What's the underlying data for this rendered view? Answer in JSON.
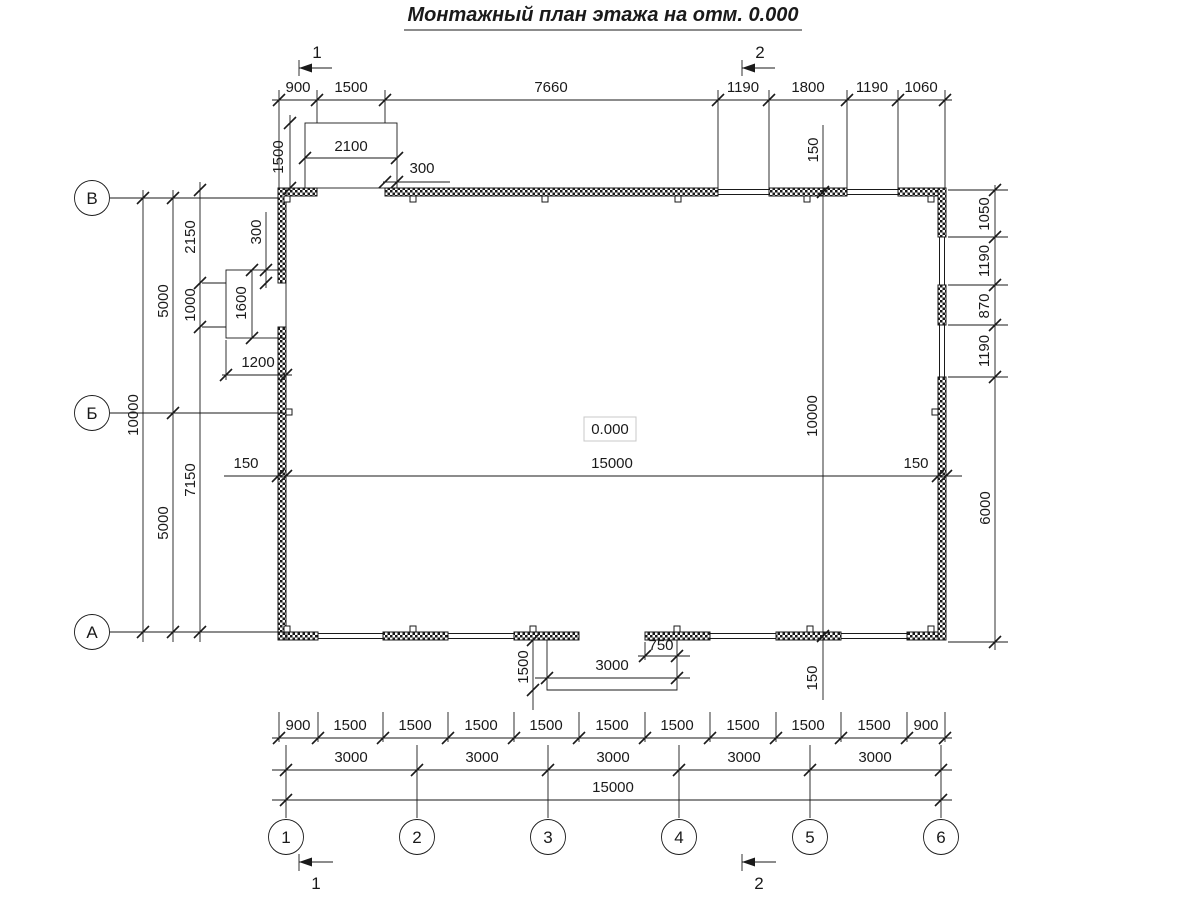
{
  "title": "Монтажный план этажа на отм. 0.000",
  "elevation": "0.000",
  "axes": {
    "rows": [
      "В",
      "Б",
      "А"
    ],
    "cols": [
      "1",
      "2",
      "3",
      "4",
      "5",
      "6"
    ]
  },
  "sections": {
    "one": "1",
    "two": "2"
  },
  "dims": {
    "top_chain": [
      "900",
      "1500",
      "7660",
      "1190",
      "1800",
      "1190",
      "1060"
    ],
    "porch_top": {
      "depth": "1500",
      "width": "2100",
      "offset": "300"
    },
    "left": {
      "total": "10000",
      "upper": "5000",
      "lower": "5000",
      "to_opening": "2150",
      "opening_gap": "1000",
      "below_opening": "7150"
    },
    "left_opening": {
      "height": "1600",
      "width": "1200",
      "offset": "300"
    },
    "mid_width": {
      "wall_left": "150",
      "span": "15000",
      "wall_right": "150"
    },
    "mid_height": {
      "wall_top": "150",
      "span": "10000",
      "wall_bottom": "150"
    },
    "right_chain": [
      "1050",
      "1190",
      "870",
      "1190"
    ],
    "right_lower": "6000",
    "entry_porch": {
      "depth": "1500",
      "width": "3000",
      "offset": "750"
    },
    "bottom_row1": [
      "900",
      "1500",
      "1500",
      "1500",
      "1500",
      "1500",
      "1500",
      "1500",
      "1500",
      "1500",
      "900"
    ],
    "bottom_row2": [
      "3000",
      "3000",
      "3000",
      "3000",
      "3000"
    ],
    "bottom_total": "15000"
  }
}
